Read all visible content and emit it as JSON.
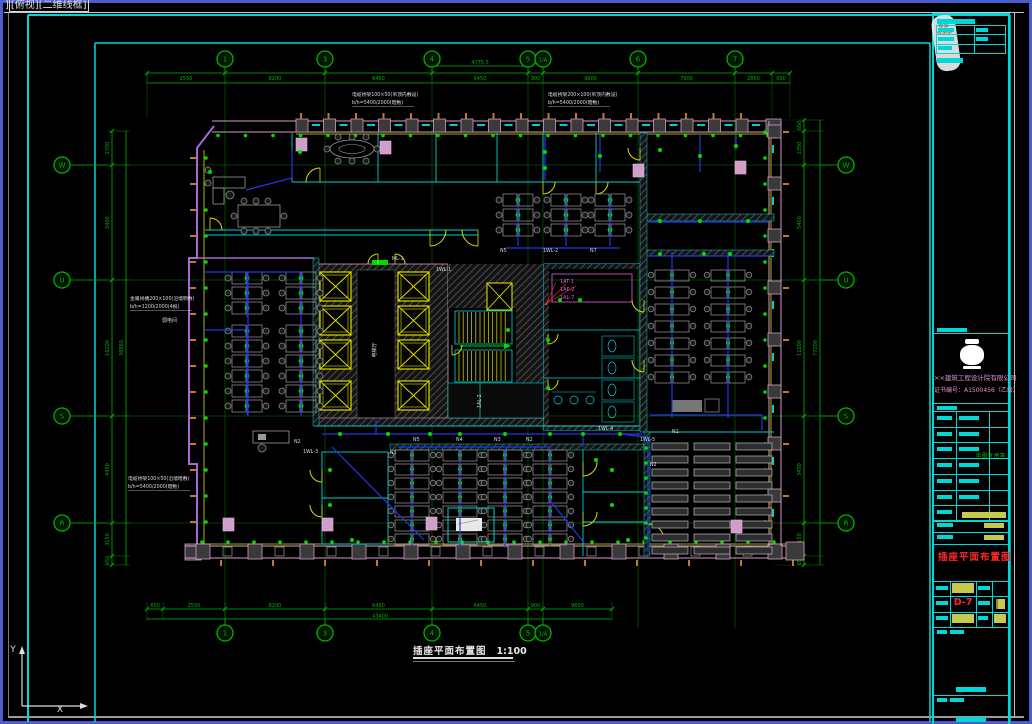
{
  "window": {
    "viewport_prefix": "]",
    "viewport_label": "[俯视][二维线框]"
  },
  "ucs": {
    "x_label": "X",
    "y_label": "Y"
  },
  "sheet_title": {
    "text": "插座平面布置图",
    "scale": "1:100"
  },
  "grid": {
    "top_bubbles": [
      "1",
      "3",
      "4",
      "5",
      "1/A",
      "6",
      "7"
    ],
    "bottom_bubbles": [
      "1",
      "3",
      "4",
      "5",
      "1/A"
    ],
    "left_bubbles": [
      "W",
      "U",
      "S",
      "R"
    ],
    "right_bubbles": [
      "W",
      "U",
      "S",
      "R"
    ]
  },
  "dimensions": {
    "top": {
      "segments": [
        "2550",
        "8200",
        "6450",
        "6450",
        "900",
        "9600",
        "7900",
        "2850",
        "650"
      ],
      "sub": "4775.5"
    },
    "bottom": {
      "segments": [
        "650",
        "2550",
        "8200",
        "6450",
        "6450",
        "900",
        "9600"
      ],
      "total": "43400"
    },
    "left": {
      "segments": [
        "2350",
        "5400",
        "16200",
        "4450",
        "3150",
        "650"
      ],
      "total": "36950"
    },
    "right": {
      "segments": [
        "650",
        "2350",
        "5400",
        "11200",
        "3450",
        "3150",
        "650"
      ],
      "total": "77200"
    }
  },
  "annotations": {
    "top1": [
      "电缆桥架100×50(吊顶内敷设)",
      "b/h=5400/2000(暗敷)"
    ],
    "top2": [
      "电缆桥架200×100(吊顶内敷设)",
      "b/h=5400/2000(暗敷)"
    ],
    "left": [
      "金属线槽200×100(沿墙明敷)",
      "b/h=1200/2000(4根)"
    ],
    "bottom_left": [
      "电缆桥架100×50(沿墙暗敷)",
      "b/h=5400/2000(暗敷)"
    ],
    "room_left": "弱电间",
    "core_lobby": "电梯厅"
  },
  "equipment_labels": [
    "1AT-1",
    "1AP-2",
    "1AL-7"
  ],
  "wire_labels": [
    {
      "t": "ML-1",
      "x": 392,
      "y": 260
    },
    {
      "t": "1WL-1",
      "x": 436,
      "y": 271
    },
    {
      "t": "N5",
      "x": 500,
      "y": 252
    },
    {
      "t": "1WL-2",
      "x": 543,
      "y": 252
    },
    {
      "t": "N7",
      "x": 590,
      "y": 252
    },
    {
      "t": "N2",
      "x": 294,
      "y": 443
    },
    {
      "t": "1WL-3",
      "x": 303,
      "y": 453
    },
    {
      "t": "N1",
      "x": 390,
      "y": 454
    },
    {
      "t": "N5",
      "x": 413,
      "y": 441
    },
    {
      "t": "N4",
      "x": 456,
      "y": 441
    },
    {
      "t": "N3",
      "x": 494,
      "y": 441
    },
    {
      "t": "N2",
      "x": 526,
      "y": 441
    },
    {
      "t": "1WL-4",
      "x": 598,
      "y": 430
    },
    {
      "t": "1WL-5",
      "x": 640,
      "y": 441
    },
    {
      "t": "N1",
      "x": 672,
      "y": 433
    },
    {
      "t": "N2",
      "x": 650,
      "y": 466
    },
    {
      "t": "1AL-2",
      "x": 481,
      "y": 408,
      "r": -90
    }
  ],
  "title_block": {
    "company_line1": "××建筑工程设计院有限公司",
    "company_line2": "证书编号：A1500456（乙级）",
    "stamp_note": "出图专用章",
    "stamp_lines": [
      "审查",
      "专用章"
    ],
    "drawing_title": "插座平面布置图",
    "drawing_no": "D-7"
  }
}
